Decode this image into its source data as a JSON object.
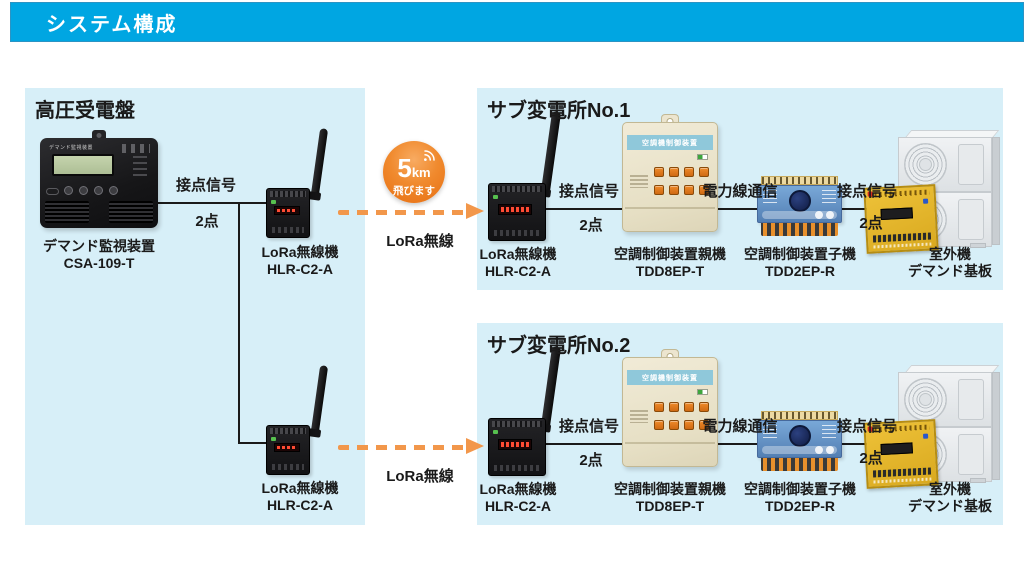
{
  "header": {
    "title": "システム構成"
  },
  "panels": {
    "left": {
      "title": "高圧受電盤"
    },
    "sub1": {
      "title": "サブ変電所No.1"
    },
    "sub2": {
      "title": "サブ変電所No.2"
    }
  },
  "badge": {
    "value": "5",
    "unit": "km",
    "caption": "飛びます"
  },
  "labels": {
    "contact_signal": "接点信号",
    "points": "2点",
    "powerline": "電力線通信",
    "lora": "LoRa無線"
  },
  "devices": {
    "demand_monitor": {
      "name": "デマンド監視装置",
      "model": "CSA-109-T",
      "face_label": "デマンド監視装置"
    },
    "lora_unit": {
      "name": "LoRa無線機",
      "model": "HLR-C2-A"
    },
    "ac_master": {
      "name": "空調制御装置親機",
      "model": "TDD8EP-T",
      "face_label": "空調機制御装置"
    },
    "ac_slave": {
      "name": "空調制御装置子機",
      "model": "TDD2EP-R"
    },
    "outdoor_unit": {
      "name": "室外機",
      "model": "デマンド基板"
    }
  },
  "colors": {
    "header_bg": "#00a6e2",
    "panel_bg": "#d7eff8",
    "arrow_orange": "#f2974b",
    "badge_orange": "#ee7c1f",
    "line_black": "#1a1a1a"
  }
}
